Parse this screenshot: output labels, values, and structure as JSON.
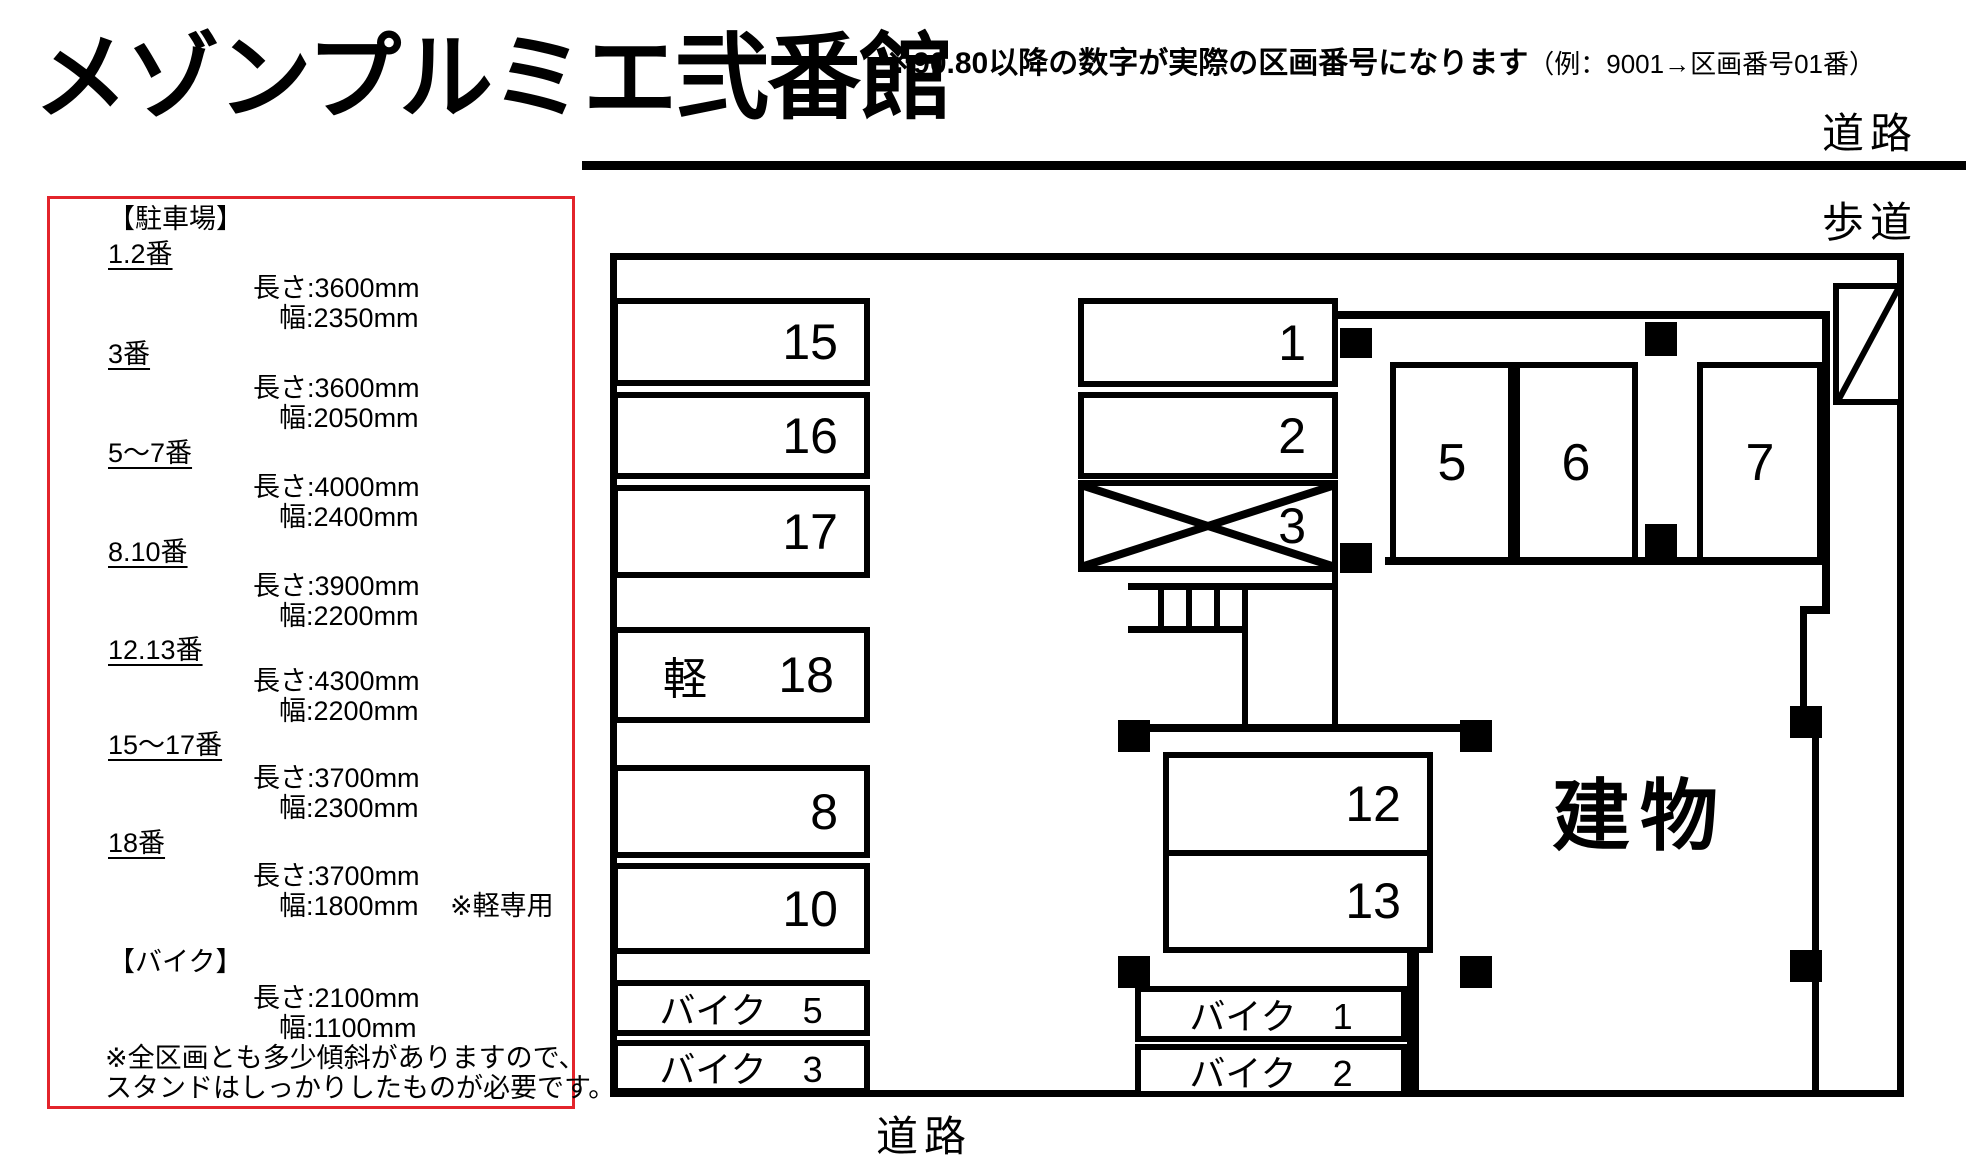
{
  "title": "メゾンプルミエ弐番館",
  "header_note": {
    "main": "※90.80以降の数字が実際の区画番号になります",
    "example": "（例：9001→区画番号01番）"
  },
  "road_labels": {
    "top": "道路",
    "sidewalk": "歩道",
    "bottom": "道路"
  },
  "legend": {
    "parking_header": "【駐車場】",
    "entries": [
      {
        "label": "1.2番",
        "length": "長さ:3600mm",
        "width": "幅:2350mm",
        "note": ""
      },
      {
        "label": "3番",
        "length": "長さ:3600mm",
        "width": "幅:2050mm",
        "note": ""
      },
      {
        "label": "5〜7番",
        "length": "長さ:4000mm",
        "width": "幅:2400mm",
        "note": ""
      },
      {
        "label": "8.10番",
        "length": "長さ:3900mm",
        "width": "幅:2200mm",
        "note": ""
      },
      {
        "label": "12.13番",
        "length": "長さ:4300mm",
        "width": "幅:2200mm",
        "note": ""
      },
      {
        "label": "15〜17番",
        "length": "長さ:3700mm",
        "width": "幅:2300mm",
        "note": ""
      },
      {
        "label": "18番",
        "length": "長さ:3700mm",
        "width": "幅:1800mm",
        "note": "※軽専用"
      }
    ],
    "bike_header": "【バイク】",
    "bike_length": "長さ:2100mm",
    "bike_width": "幅:1100mm",
    "footnote_line1": "※全区画とも多少傾斜がありますので、",
    "footnote_line2": "スタンドはしっかりしたものが必要です。"
  },
  "map": {
    "building_label": "建物",
    "left_spaces": [
      {
        "label": "15"
      },
      {
        "label": "16"
      },
      {
        "label": "17"
      }
    ],
    "kei_space": {
      "prefix": "軽",
      "label": "18"
    },
    "mid_left_spaces": [
      {
        "label": "8"
      },
      {
        "label": "10"
      }
    ],
    "bike_left_spaces": [
      {
        "label": "バイク　5"
      },
      {
        "label": "バイク　3"
      }
    ],
    "top_spaces": [
      {
        "label": "1"
      },
      {
        "label": "2"
      },
      {
        "label": "3"
      }
    ],
    "row_spaces": [
      {
        "label": "5"
      },
      {
        "label": "6"
      },
      {
        "label": "7"
      }
    ],
    "center_spaces": [
      {
        "label": "12"
      },
      {
        "label": "13"
      }
    ],
    "bike_center_spaces": [
      {
        "label": "バイク　1"
      },
      {
        "label": "バイク　2"
      }
    ]
  },
  "colors": {
    "line": "#000000",
    "legend_border": "#e3242b"
  }
}
